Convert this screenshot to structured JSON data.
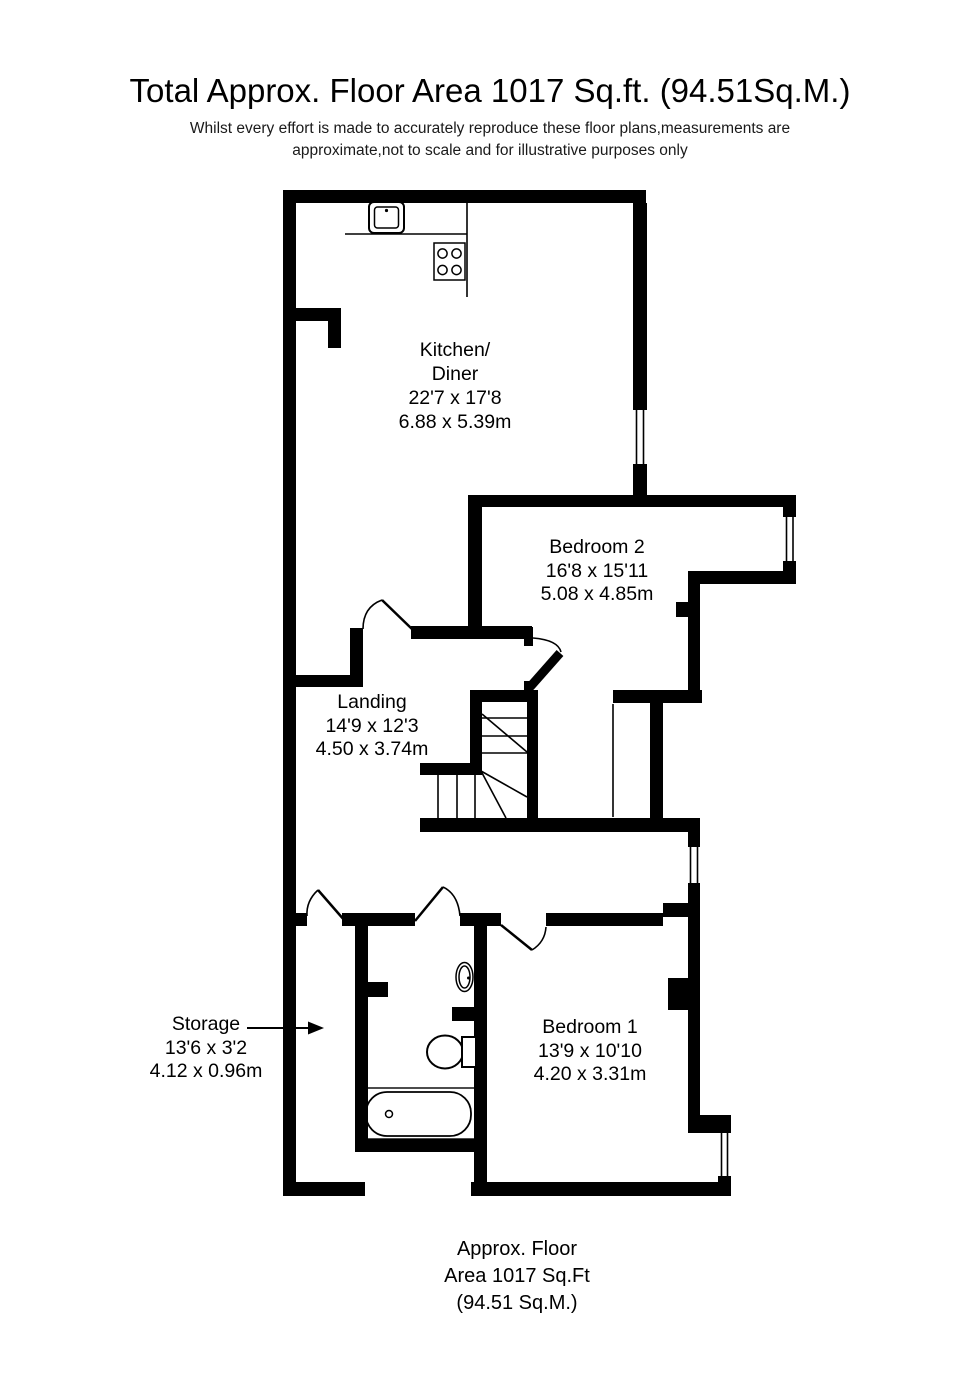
{
  "title": "Total Approx. Floor Area 1017 Sq.ft. (94.51Sq.M.)",
  "disclaimer": {
    "line1": "Whilst every effort is made to accurately reproduce these floor plans,measurements are",
    "line2": "approximate,not to scale and for illustrative purposes only"
  },
  "rooms": {
    "kitchen": {
      "name_line1": "Kitchen/",
      "name_line2": "Diner",
      "size_imperial": "22'7 x 17'8",
      "size_metric": "6.88 x 5.39m"
    },
    "bedroom2": {
      "name": "Bedroom 2",
      "size_imperial": "16'8 x 15'11",
      "size_metric": "5.08 x 4.85m"
    },
    "landing": {
      "name": "Landing",
      "size_imperial": "14'9 x 12'3",
      "size_metric": "4.50 x 3.74m"
    },
    "storage": {
      "name": "Storage",
      "size_imperial": "13'6 x 3'2",
      "size_metric": "4.12 x 0.96m"
    },
    "bedroom1": {
      "name": "Bedroom 1",
      "size_imperial": "13'9 x 10'10",
      "size_metric": "4.20 x 3.31m"
    }
  },
  "footer": {
    "line1": "Approx. Floor",
    "line2": "Area 1017 Sq.Ft",
    "line3": "(94.51 Sq.M.)"
  },
  "colors": {
    "wall": "#000000",
    "background": "#ffffff",
    "text": "#000000"
  }
}
